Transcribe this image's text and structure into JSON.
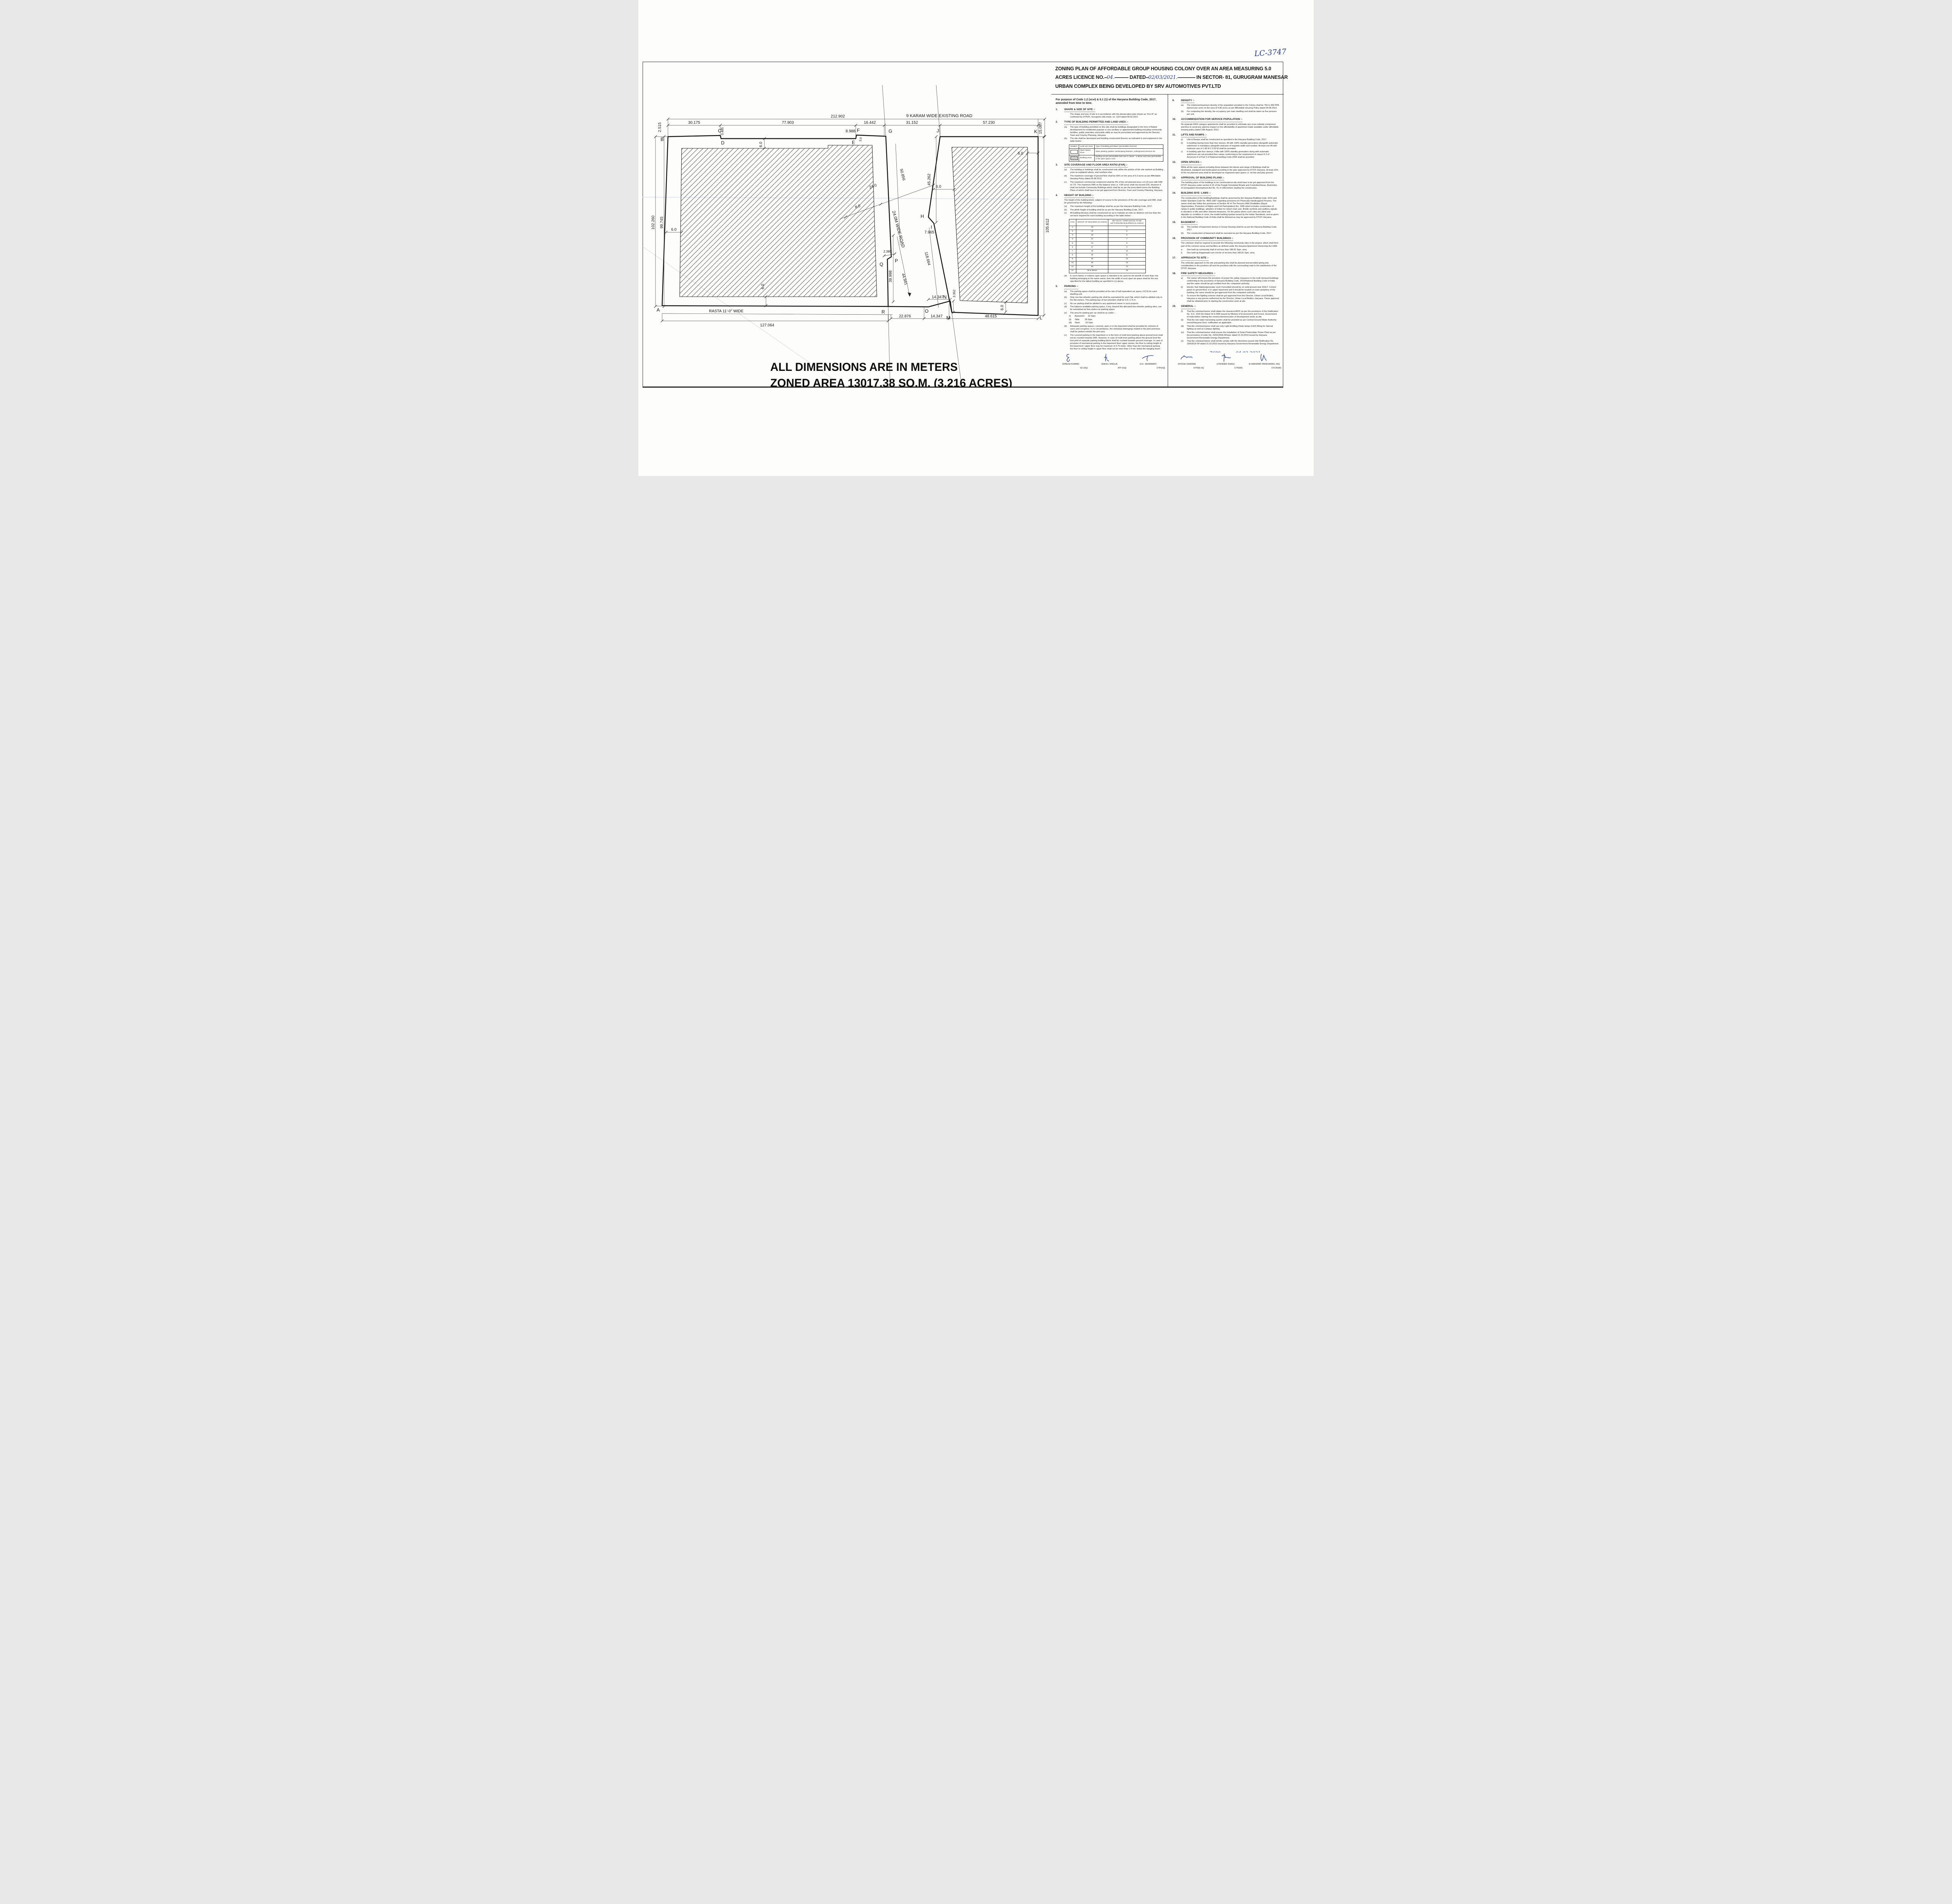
{
  "ink": {
    "handwriting": "#1f3a9d",
    "line": "#1a1a1a"
  },
  "lc_number": "LC-3747",
  "title": {
    "line1": "ZONING PLAN OF AFFORDABLE GROUP HOUSING COLONY OVER AN  AREA MEASURING 5.0",
    "line2_pre": "ACRES LICENCE NO.",
    "line2_hw1": "04.",
    "line2_dash1": "-----------",
    "line2_mid": "DATED",
    "line2_hw2": "02/03/2021.",
    "line2_dash2": "--------------",
    "line2_post": " IN SECTOR- 81, GURUGRAM MANESAR",
    "line3": "URBAN COMPLEX  BEING DEVELOPED BY SRV AUTOMOTIVES PVT.LTD"
  },
  "plan": {
    "road_top": "9 KARAM WIDE EXISTING ROAD",
    "road_diag": "24.0M WIDE ROAD",
    "rasta": "RASTA 11'-0\" WIDE",
    "note1": "ALL DIMENSIONS ARE IN METERS",
    "note2": "ZONED AREA  13017.38 SQ.M. (3.216 ACRES)",
    "points": [
      "A",
      "B",
      "C",
      "D",
      "E",
      "F",
      "G",
      "H",
      "I",
      "J",
      "K",
      "L",
      "M",
      "N",
      "O",
      "P",
      "Q",
      "R"
    ],
    "dims": {
      "d212": "212.902",
      "d30": "30.175",
      "d77": "77.903",
      "d16": "16.442",
      "d31": "31.152",
      "d57": "57.230",
      "d2515": "2.515",
      "d0485": "0.485",
      "d8988": "8.988",
      "d3": "3.0",
      "d102": "102.260",
      "d99": "99.745",
      "d6": "6.0",
      "d24": "24.0",
      "d8": "8.0",
      "d50": "50.856",
      "d45": "45.262",
      "d15": "15.087",
      "d105": "105.612",
      "d118": "118.664",
      "d7965": "7.965",
      "d2385": "2.385",
      "d39": "39.998",
      "d44": "44.941",
      "d3352": "3.352",
      "d14": "14.347",
      "d22": "22.876",
      "d48": "48.615",
      "d127": "127.064"
    }
  },
  "notes": {
    "intro": "For purpose of Code 1.2 (xcvi) & 6.1 (1) of the Haryana Building Code, 2017, amended from time to time.",
    "left": [
      {
        "no": "1.",
        "title": "SHAPE & SIZE OF SITE :-",
        "items": [
          {
            "t": "The shape and size of site is in accordance with the demarcation plan shown as \"A to R\" as confirmed by DTP(P), Gurugram vide endst. no. 1119 dated 09.02.2021"
          }
        ]
      },
      {
        "no": "2.",
        "title": "TYPE OF BUILDING PERMITTED AND LAND USES :-",
        "items": [
          {
            "l": "(a).",
            "t": "The type of building permitted on this site shall be buildings designated in the form of flatted development for residential purpose or any ancillary or appurtenant building  including community facilities, public amenities and public utility as may be prescribed and approved by the Director, Town and Country Planning, Haryana."
          },
          {
            "l": "(b).",
            "t": "The site shall be developed and building constructed thereon as indicated in and explained in the table below:-"
          }
        ],
        "table": "landuse"
      },
      {
        "no": "3.",
        "title": "SITE COVERAGE AND FLOOR AREA RATIO (FAR) :-",
        "items": [
          {
            "l": "(a)",
            "t": "The building or buildings shall be constructed only within the portion of the site marked as Building zone as explained above, and nowhere else."
          },
          {
            "l": "(b)",
            "t": "The maximum coverage of ground floor shall be 50%  on the area of 5.0 acres as per Affordable  Housing Policy dated 09.08.2013"
          },
          {
            "l": "(c)",
            "t": "The maximum commercial component shall be 4% of the net planned area i.e.0.20 acre with  FAR of 175. The maximum FAR on the balance area i.e. 4.80 acres shall not exceed 225. However it shall not include Community Buildings which shall be as per the prescribed norms the Building Plans of which shall have to be got approved from Director, Town and Country Planning, Haryana."
          }
        ]
      },
      {
        "no": "4.",
        "title": "HEIGHT OF BUILDING :-",
        "lead": "The height of the building block, subject  of course to the provisions of the site coverage and FAR, shall be governed by the following:-",
        "items": [
          {
            "l": "(a)",
            "t": "The maximum height of the buildings shall be as per the Haryana Building Code, 2017."
          },
          {
            "l": "(b)",
            "t": "The plinth height of building shall be as per the Haryana Building Code, 2017."
          },
          {
            "l": "(c)",
            "t": "All building block(s) shall be constructed so as to maintain an inter-se distance not less than the set back required for each building according to the table below:-"
          }
        ],
        "table": "height",
        "items2": [
          {
            "l": "(d)",
            "t": "If, such interior or exterior open space is intended to be used for the benefit of more than one building belonging to the same owner, then the width of such open air space shall be the one specified for the tallest building as specified in (c) above."
          }
        ]
      },
      {
        "no": "5.",
        "title": "PARKING :-",
        "items": [
          {
            "l": "(a)",
            "t": "The parking space shall be provided at the rate of half equivalent car space ( ECS) for each dwelling unit."
          },
          {
            "l": "(b)",
            "t": "Only one two-wheeler parking site shall be earmarked for each flat, which shall be allotted only to the flat-owners. The parking bay of two-wheelers shall be 0.8 x 2.5 m."
          },
          {
            "l": "(c)",
            "t": "No car parking shall be allotted to any apartment owner in such projects."
          },
          {
            "l": "(d)",
            "t": "The balance available parking space, if any, beyond the allocated two-wheeler parking sites, can be earmarked as free-visitor-car-parking space."
          },
          {
            "l": "(e)",
            "t": "The area for parking per car shall be as under :-"
          },
          {
            "l": "(i)",
            "t": "Basement      32 Sqm.",
            "ind": true
          },
          {
            "l": "(ii)",
            "t": "Stilts         28 Sqm.",
            "ind": true
          },
          {
            "l": "(iii)",
            "t": "Open         23 Sqm.",
            "ind": true
          },
          {
            "l": "(b)",
            "t": "Adequate parking spaces, covered, open or in the basement shall be provided for vehicles of users and occupiers, In no circumstance, the vehicle(s) belonging/ related to the plot/ premises shall be parked outside the plot area."
          },
          {
            "l": "(c)",
            "t": "The covered parking in the basement or in the form of multi level parking above ground level shall not be counted towards FAR. However, in case of multi level parking above the ground level the foot print of separate parking building block shall be counted towards ground coverage. In case of provision of mechanical parking in the basement floor/ upper stories, the floor to ceiling height of the basement / upper floor may be maximum of 4.75 meter. Other than the mechanical parking the floor to ceiling height in upper floor shall not be more than 2.4 mtr. below the hanging beam."
          }
        ]
      },
      {
        "no": "6.",
        "title": "APPROACH TO SITE :-",
        "items": [
          {
            "l": "(a)",
            "t": "The vehicular approach to the site shall be planned and provided giving due consideration to the junctions with the surrounding roads to the satisfaction of the Competent Authority."
          },
          {
            "l": "(b)",
            "t": "The approach to the site shall be shown on the zoning plan."
          }
        ]
      },
      {
        "no": "7.",
        "title": "GATE POST AND BOUNDARY WALL :-",
        "items": [
          {
            "l": "(a)",
            "t": "Such Boundary wall, railings or their combination, hedges or fences along with gates and gate posts shall be constructed as per design approved by Competent Authority. In addition to the gate/ gates an additional wicket gate not exceeding 1.25 meters width may be allowed in the front and side boundary wall provided that no main gate or wicket gate shall be allowed to open on the sector road/public open space."
          },
          {
            "l": "(b)",
            "t": "The boundary wall shall be constructed as per the Haryana Building Code, 2017."
          }
        ]
      }
    ],
    "right": [
      {
        "no": "9.",
        "title": "DENSITY :-",
        "items": [
          {
            "l": "(a)",
            "t": "The minimum/maximum density of the population provided in the Colony shall be 750 to 900 PPA (person per acre) on the area of 4.80 acres as per Affordable  Housing Policy dated 09.08.2013."
          },
          {
            "l": "(b)",
            "t": "For computing the density, the occupancy per main dwelling unit shall be taken as five persons per unit."
          }
        ]
      },
      {
        "no": "10.",
        "title": "ACCOMMODATION FOR SERVICE POPULATION :-",
        "lead": "No separate EWS category apartments shall be provided to eliminate any cross subsidy component and thus to avoid any adverse impact on the affordability of apartment made available under affordable housing policy dated 19th August, 2013."
      },
      {
        "no": "11.",
        "title": "LIFTS AND RAMPS :-",
        "items": [
          {
            "l": "a)",
            "t": "Lifts & Ramps shall be constructed as specified in the Haryana Building Code, 2017."
          },
          {
            "l": "b)",
            "t": "In building having more than four storeys, lift with 100% standby generators alongwith automatic switchover is mandatory alongwith staircase of requisite width and number. At least one lift  with minimum size of 1.80 M X 3.00 M shall be provided."
          },
          {
            "l": "c)",
            "t": "In building upto four storeys, if lifts with 100% standby generators  along with automatic switchover are not provided then ramps conforming to the requirement of clause D-3 of Annexure-D of Part 3 of National building Code-2005 shall be provided."
          }
        ]
      },
      {
        "no": "12.",
        "title": "OPEN SPACES :-",
        "lead": "While all the open spaces including those between the blocks and wings of Buildings shall be developed, equipped and landscaped according to the plan approved by DTCP, Haryana. At least 15% of the net planned area shall be developed as organized open space i.e. tot lots and play ground."
      },
      {
        "no": "13.",
        "title": "APPROVAL OF BUILDING PLANS :-",
        "lead": "The building plans of the buildings to be constructed at site shall have to be got approved from the DTCP, Haryana under section 8 (2) of the Punjab Scheduled Roads and Controlled Areas, Restriction of Unregulated Development Act No. 41 of 1963 before starting the construction."
      },
      {
        "no": "14.",
        "title": "BUILDING BYE- LAWS :-",
        "lead": "The construction of the building/buildings shall be governed by the Haryana Building Code, 2016 and Indian Standard Code No. 4963-1987 regarding provisions for Physically Handicapped Persons. The owner shall also follow the provisions of Section 46 of The Persons With Disabilities (Equal Opportunities, Protection of Rights and Full Participation) Act, 1995 which includes construction of ramps in public buildings, adoption of toilets for wheel chair user, Braille symbols and auditory signals in elevators or lifts and other relevant measures. On  the points where such rules are silent and stipulate no condition or norm, the model building byelaw issued by the Indian Standards, and as given in the National Building Code of India shall be followed as may be approved by DTCP, Haryana."
      },
      {
        "no": "15.",
        "title": "BASEMENT :-",
        "items": [
          {
            "l": "(a)",
            "t": "The number of basement storeys in Group Housing shall be as per the Haryana Building Code, 2017."
          },
          {
            "l": "(b)",
            "t": "The construction of basement shall be executed as per the Haryana Building Code, 2017."
          }
        ]
      },
      {
        "no": "16.",
        "title": "PROVISION OF COMMUNITY BUILDINGS :-",
        "lead": "The coloniser shall be required to provide the following community sites in the project, which shall form part of the common areas and facilities as defined under the Haryana Apartment Ownership Act-1983.",
        "items": [
          {
            "l": "a.",
            "t": "One built-up community Hall of not less than 185.81 Sqm. area."
          },
          {
            "l": "b.",
            "t": "One built-up Anganwadi-cum-creche of not less than 185.81 Sqm. area."
          }
        ]
      },
      {
        "no": "17.",
        "title": "APPROACH TO SITE :-",
        "lead": "The vehicular approach to the site and parking lots shall be planned and provided giving due consideration to the junctions off and the junctions with the surrounding road to the satisfaction of the DTCP, Haryana."
      },
      {
        "no": "18.",
        "title": "FIRE SAFETY MEASURES :-",
        "items": [
          {
            "l": "a)",
            "t": "The owner will ensure the provision of proper fire safety measures in the multi storeyed buildings conforming to the provisions of Haryana Building Code, 2016/National Building Code of India and the same should be got certified from the competent authority."
          },
          {
            "l": "b)",
            "t": "Electric Sub Station/generator room if provided should be on solid ground near DG/LT. Control panel on ground floor or in upper basement and it should be located on outer periphery of the building, the same should be got approved from the competent authority."
          },
          {
            "l": "c)",
            "t": "To ensure fire fighting scheme shall be got approved from the Director, Urban Local Bodies, Haryana or any person authorized by the Director, Urban Local Bodies, Haryana. These approval shall be obtained prior to starting the construction work at site."
          }
        ]
      },
      {
        "no": "19.",
        "title": "GENERAL :-",
        "items": [
          {
            "l": "(i)",
            "t": "That the coloniser/owner shall obtain the clearance/NOC as per the provisions of the Notification No. S.O. 1533 (E) Dated 14.9.2006  issued by Ministry of Environment and Forest, Government of India  before starting the construction/execution of development works at site."
          },
          {
            "l": "(ii)",
            "t": "That the rain water harvesting system shall be provided as per Central Ground Water Authority norms/Haryana Govt. notification as applicable."
          },
          {
            "l": "(iii)",
            "t": "That the coloniser/owner shall use only Light-Emitting Diode lamps (LED) fitting for internal lighting as well as  Campus lighting."
          },
          {
            "l": "(iv)",
            "t": "That the coloniser/owner shall ensure the installation of Solar Photovoltaic Power Plant as per the provisions of order No. 22/52/2005-5Power dated 21.03.2016 issued by Haryana Government Renewable Energy Department."
          },
          {
            "l": "(v)",
            "t": "That the coloniser/owner shall strictly comply with the directions issued vide Notification No. 19/6/2016-5P dated 31.03.2016 issued by Haryana Government Renewable Energy Department."
          }
        ]
      }
    ],
    "landuse_table": {
      "headers": [
        "Notation",
        "Land use Zone",
        "Type of Building permitted / permissible structure"
      ],
      "rows": [
        {
          "swatch": "open-rect-icon",
          "zone": "Open Space Zone",
          "type": "Open parking, garden, landscaping features, underground services etc."
        },
        {
          "swatch": "hatch-rect-icon",
          "zone": "Building Zone",
          "type": "Building as per permissible land use in clause - a above and uses permissible in the open space zone."
        }
      ]
    },
    "height_table": {
      "headers": [
        "S.No.",
        "HEIGHT OF BUILDING (in meters)",
        "SET BACK / OPEN SPACE TO BE LEFTAROUND BUILDINGS.(in meters)"
      ],
      "rows": [
        [
          "1.",
          "10",
          "3"
        ],
        [
          "2.",
          "15",
          "5"
        ],
        [
          "3.",
          "18",
          "6"
        ],
        [
          "4.",
          "21",
          "7"
        ],
        [
          "5.",
          "24",
          "8"
        ],
        [
          "6.",
          "27",
          "9"
        ],
        [
          "7.",
          "30",
          "10"
        ],
        [
          "8.",
          "35",
          "11"
        ],
        [
          "9.",
          "40",
          "12"
        ],
        [
          "10.",
          "45",
          "13"
        ],
        [
          "11.",
          "50",
          "14"
        ],
        [
          "12.",
          "55 & above",
          "16"
        ]
      ]
    },
    "drg": {
      "label1": "DRG. No.  DTCP",
      "value1": "7680",
      "label2": "DATED",
      "value2": "04-03-2021"
    }
  },
  "signatures": [
    {
      "name": "(DINESH KUMAR)",
      "role": "SD (HQ)"
    },
    {
      "name": "(RAHUL SINGLA)",
      "role": "ATP (HQ)"
    },
    {
      "name": "(S.K. SEHRAWAT)",
      "role": "DTP(HQ)"
    },
    {
      "name": "(HITESH SHARMA)",
      "role": "STP(M) HQ"
    },
    {
      "name": "(JITENDER SIHAG)",
      "role": "CTP(HR)"
    },
    {
      "name": "(K.MAKRAND PANDURANG, IAS)",
      "role": "DTCP(HR)"
    }
  ]
}
